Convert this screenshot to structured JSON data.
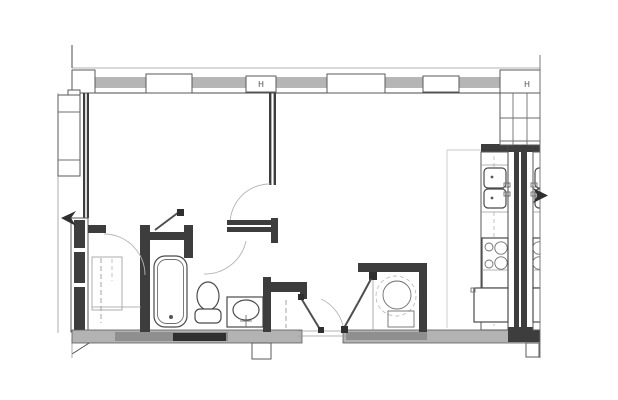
{
  "document": {
    "type": "architectural-floor-plan",
    "description": "Black-and-white floor plan of one apartment unit, cut at the right along a shared demising wall with a mirrored neighboring unit",
    "visible_text": "none (symbols only)"
  },
  "colors": {
    "background": "#ffffff",
    "line": "#4b4b4b",
    "wall_poche": "#3d3d3d",
    "wall_band": "#b3b3b3",
    "glazing": "#b5b5b5",
    "swing_arc": "#b4b4b4",
    "light_zone_line": "#c7c7c7"
  },
  "window_wall": {
    "operable_symbol": "H",
    "glazing_bays": 5,
    "panels": [
      "corner-block",
      "mullion-panel",
      "operable-panel-H",
      "mullion-panel",
      "mullion-panel",
      "corner-block-H"
    ]
  },
  "fixtures": {
    "bathroom": [
      "bathtub",
      "toilet",
      "vanity-sink",
      "medicine-cabinet-door"
    ],
    "laundry": [
      "washer-dryer-drum"
    ],
    "kitchen": [
      "double-bowl-sink",
      "four-burner-cooktop",
      "range",
      "refrigerator"
    ],
    "storage": [
      "bedroom-closet-rod",
      "entry-closet-rod",
      "built-in-wardrobe"
    ]
  },
  "symbols": {
    "door_swings": 5,
    "bifold_door_leaves": 2,
    "section_arrows": 2
  }
}
